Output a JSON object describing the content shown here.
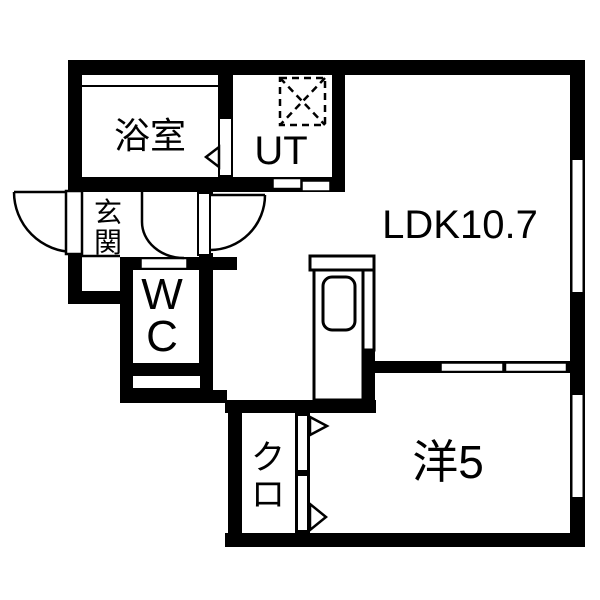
{
  "floor_plan": {
    "type": "japanese-apartment-1LDK",
    "colors": {
      "wall": "#000000",
      "floor": "#ffffff",
      "text": "#000000"
    },
    "rooms": {
      "bathroom": {
        "label": "浴室"
      },
      "utility": {
        "label": "UT"
      },
      "entrance": {
        "label": "玄関",
        "chars": [
          "玄",
          "関"
        ]
      },
      "toilet": {
        "label": "WC",
        "chars": [
          "W",
          "C"
        ]
      },
      "ldk": {
        "label": "LDK10.7"
      },
      "closet": {
        "label": "クロ",
        "chars": [
          "ク",
          "ロ"
        ]
      },
      "western_room": {
        "label": "洋5"
      }
    },
    "symbols": [
      "washing-machine-pan",
      "kitchen-counter",
      "kitchen-sink",
      "hinged-door-swing",
      "sliding-door",
      "window",
      "door-direction-arrow",
      "entrance-step"
    ]
  }
}
